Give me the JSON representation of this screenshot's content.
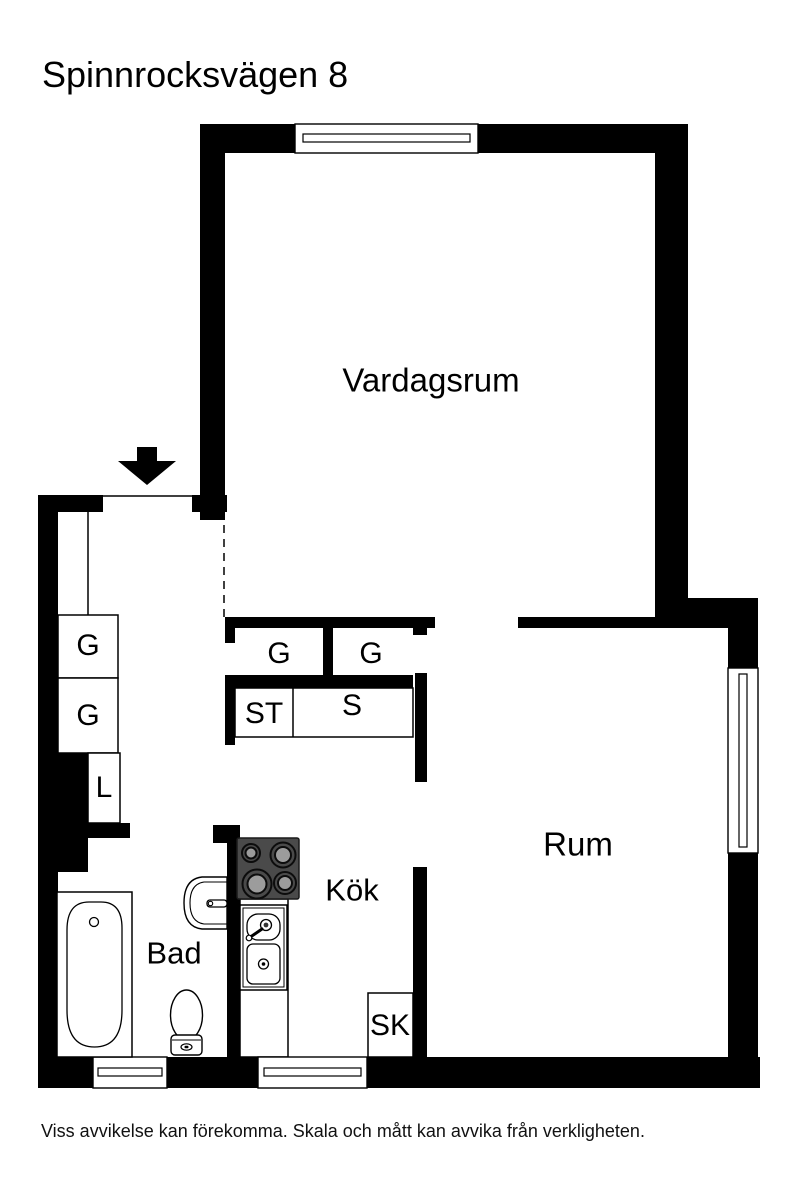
{
  "page": {
    "title": "Spinnrocksvägen 8",
    "disclaimer": "Viss avvikelse kan förekomma. Skala och mått kan avvika från verkligheten."
  },
  "rooms": {
    "living_room": "Vardagsrum",
    "bedroom": "Rum",
    "kitchen": "Kök",
    "bathroom": "Bad"
  },
  "labels": {
    "hall_wardrobe_1": "G",
    "hall_wardrobe_2": "G",
    "hall_linen_closet": "L",
    "mid_wardrobe_1": "G",
    "mid_wardrobe_2": "G",
    "cleaning_closet": "ST",
    "shelf_closet": "S",
    "kitchen_closet": "SK"
  },
  "colors": {
    "wall": "#000000",
    "background": "#ffffff",
    "stove_body": "#4a4a4a",
    "stove_burner": "#9c9c9c"
  }
}
